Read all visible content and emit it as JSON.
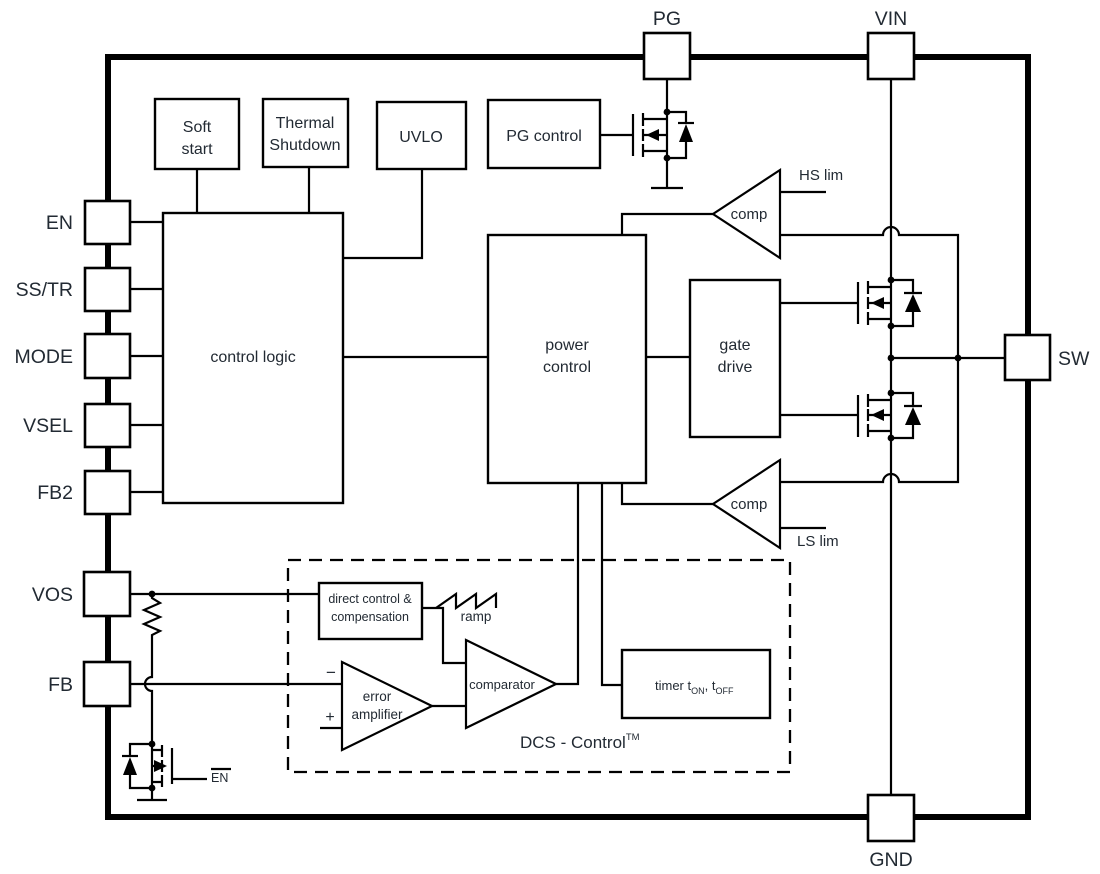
{
  "pins": {
    "pg": "PG",
    "vin": "VIN",
    "sw": "SW",
    "gnd": "GND",
    "en": "EN",
    "ss_tr": "SS/TR",
    "mode": "MODE",
    "vsel": "VSEL",
    "fb2": "FB2",
    "vos": "VOS",
    "fb": "FB"
  },
  "blocks": {
    "soft_start": {
      "line1": "Soft",
      "line2": "start"
    },
    "thermal_shutdown": {
      "line1": "Thermal",
      "line2": "Shutdown"
    },
    "uvlo": "UVLO",
    "pg_control": "PG control",
    "control_logic": "control logic",
    "power_control": {
      "line1": "power",
      "line2": "control"
    },
    "gate_drive": {
      "line1": "gate",
      "line2": "drive"
    },
    "direct_control": {
      "line1": "direct control &",
      "line2": "compensation"
    },
    "timer": {
      "t1": "timer t",
      "sub1": "ON",
      "t2": ", t",
      "sub2": "OFF"
    }
  },
  "comparators": {
    "hs": {
      "label": "comp",
      "limit": "HS lim"
    },
    "ls": {
      "label": "comp",
      "limit": "LS lim"
    },
    "error_amplifier": {
      "line1": "error",
      "line2": "amplifier"
    },
    "main_comparator": "comparator",
    "minus": "−",
    "plus": "+"
  },
  "annotations": {
    "ramp": "ramp",
    "en_gate": "EN",
    "dcs": {
      "label": "DCS - Control",
      "tm": "TM"
    }
  },
  "colors": {
    "line": "#000000",
    "text": "#222a33",
    "background": "#ffffff"
  }
}
